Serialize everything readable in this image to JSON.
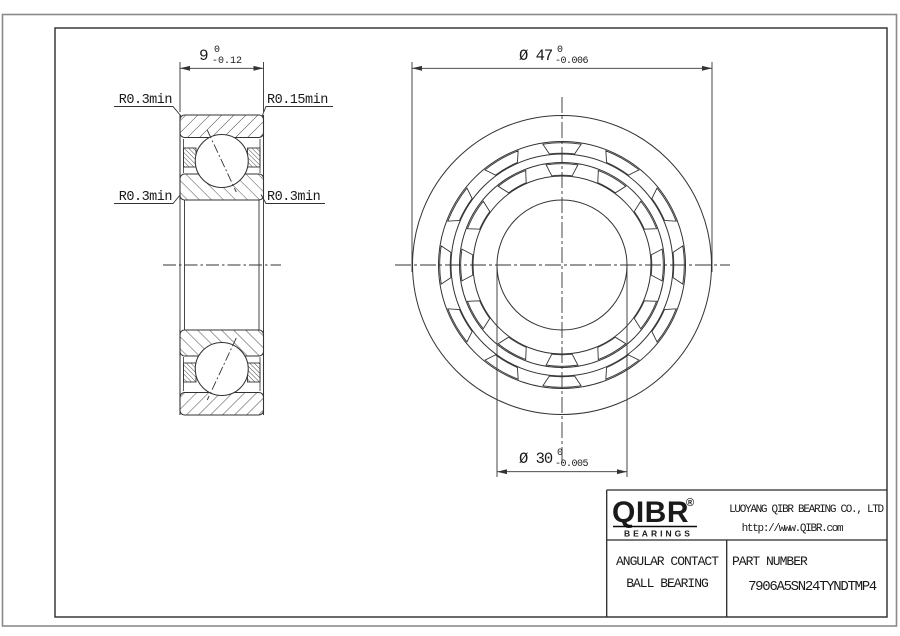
{
  "drawing": {
    "side_view": {
      "width_dim": {
        "label": "9",
        "tol_upper": "0",
        "tol_lower": "-0.12"
      },
      "radius_labels": [
        {
          "text": "R0.3min"
        },
        {
          "text": "R0.15min"
        },
        {
          "text": "R0.3min"
        },
        {
          "text": "R0.3min"
        }
      ]
    },
    "front_view": {
      "od_dim": {
        "label": "Ø 47",
        "tol_upper": "0",
        "tol_lower": "-0.006"
      },
      "bore_dim": {
        "label": "Ø 30",
        "tol_upper": "0",
        "tol_lower": "-0.005"
      }
    }
  },
  "title_block": {
    "logo_text": "QIBR",
    "logo_registered": "®",
    "logo_subtext": "BEARINGS",
    "company_name": "LUOYANG QIBR BEARING CO., LTD",
    "website": "http://www.QIBR.com",
    "product_line1": "ANGULAR CONTACT",
    "product_line2": "BALL BEARING",
    "part_number_label": "PART NUMBER",
    "part_number": "7906A5SN24TYNDTMP4"
  },
  "colors": {
    "line": "#333333",
    "frame": "#2b2b2b",
    "sheet_edge": "#8a8a8a",
    "background": "#ffffff"
  }
}
